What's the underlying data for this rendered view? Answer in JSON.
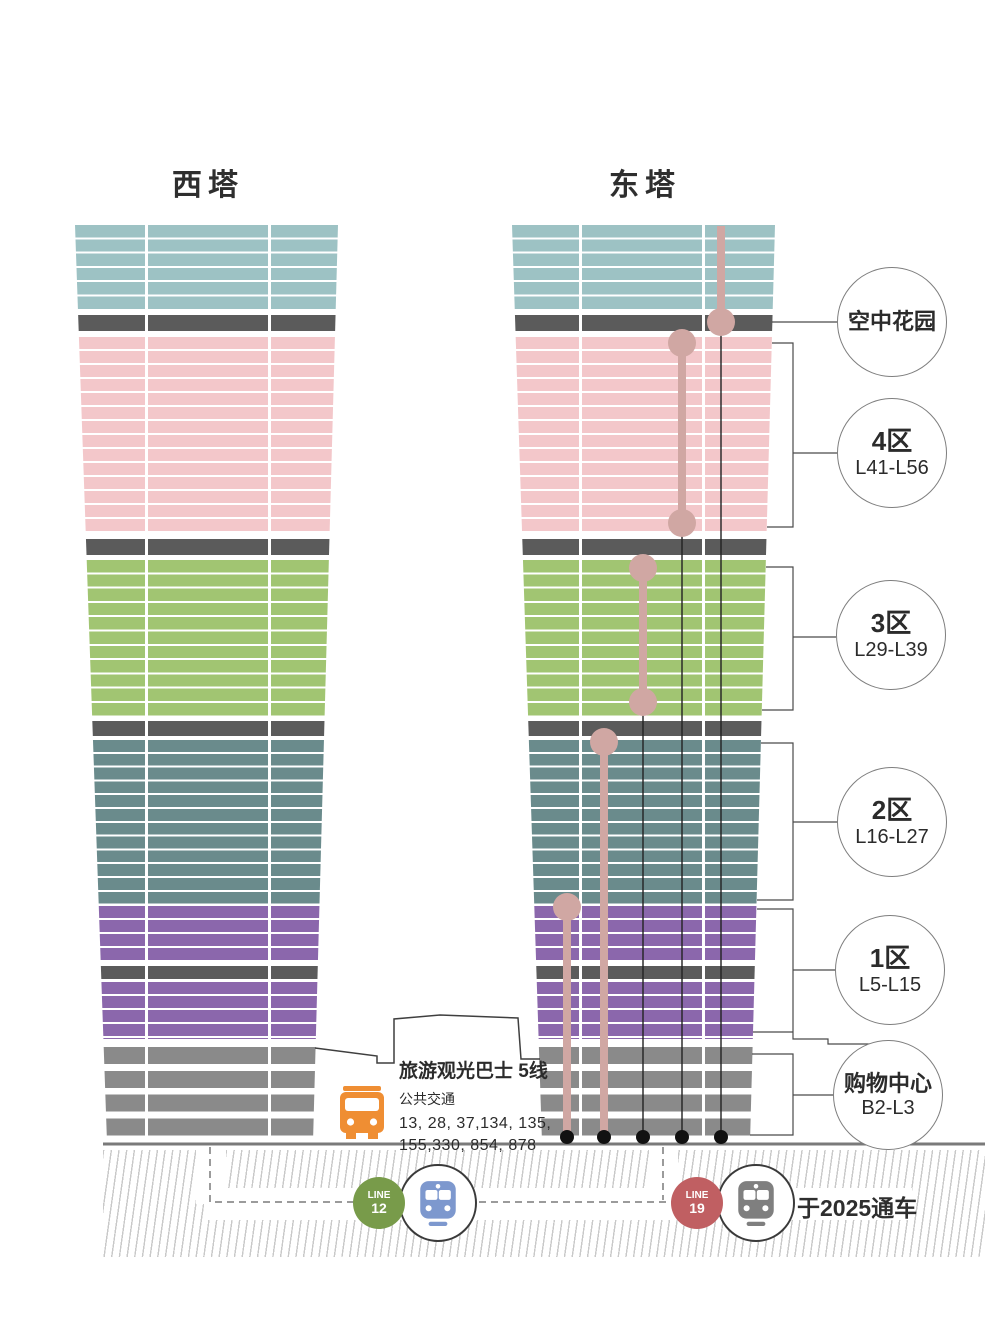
{
  "towers": {
    "west": {
      "title": "西塔"
    },
    "east": {
      "title": "东塔"
    }
  },
  "zones": [
    {
      "id": "sky-garden",
      "label": "空中花园",
      "floors": "",
      "color_key": "band_dark"
    },
    {
      "id": "zone4",
      "label": "4区",
      "floors": "L41-L56",
      "color_key": "pink"
    },
    {
      "id": "zone3",
      "label": "3区",
      "floors": "L29-L39",
      "color_key": "green"
    },
    {
      "id": "zone2",
      "label": "2区",
      "floors": "L16-L27",
      "color_key": "slate"
    },
    {
      "id": "zone1",
      "label": "1区",
      "floors": "L5-L15",
      "color_key": "purple"
    },
    {
      "id": "mall",
      "label": "购物中心",
      "floors": "B2-L3",
      "color_key": "mall_gray"
    }
  ],
  "bus": {
    "tour_line": "旅游观光巴士 5线",
    "public_transit": "公共交通",
    "routes_line1": "13, 28, 37,134, 135,",
    "routes_line2": "155,330, 854, 878"
  },
  "metro": {
    "line12": {
      "label_top": "LINE",
      "label_num": "12"
    },
    "line19": {
      "label_top": "LINE",
      "label_num": "19",
      "note": "于2025通车"
    }
  },
  "colors": {
    "teal": "#9dc2c4",
    "pink": "#f3c7ca",
    "green": "#a1c572",
    "slate": "#6a8b8c",
    "purple": "#8b67ac",
    "band_dark": "#5b5b5b",
    "mall_gray": "#8a8a8a",
    "elevator_pink": "#d0a7a3",
    "bus_orange": "#ef8e33",
    "line12_green": "#789b4a",
    "line19_red": "#c05f62",
    "train_blue": "#7d98ce",
    "train_gray": "#7f7f7f"
  }
}
